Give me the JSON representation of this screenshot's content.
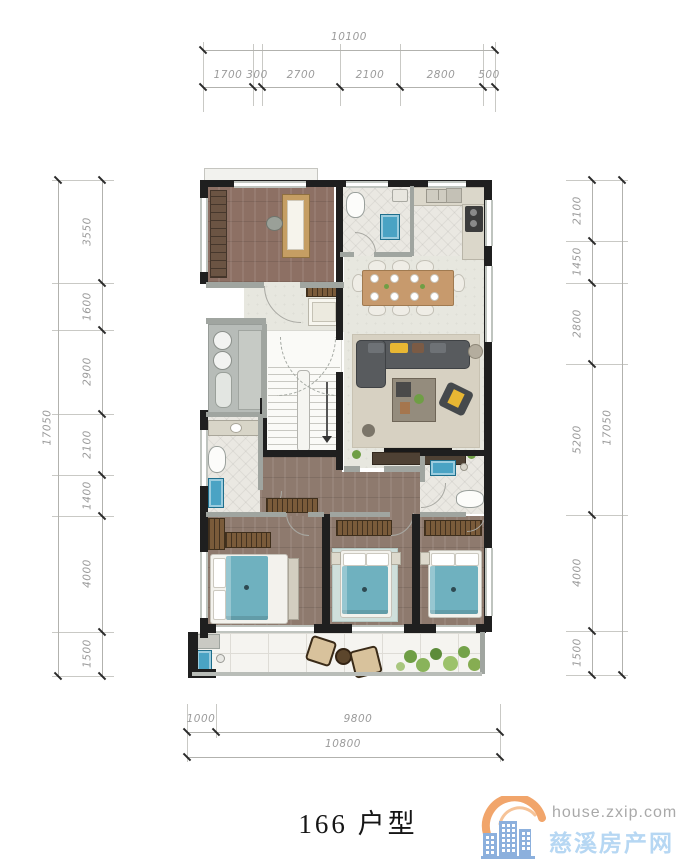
{
  "title": "166 户型",
  "dimensions": {
    "top": {
      "total": "10100",
      "segments": [
        "1700",
        "300",
        "2700",
        "2100",
        "2800",
        "500"
      ]
    },
    "left": {
      "total": "17050",
      "segments": [
        "3550",
        "1600",
        "2900",
        "2100",
        "1400",
        "4000",
        "1500"
      ]
    },
    "right": {
      "total": "17050",
      "segments": [
        "2100",
        "1450",
        "2800",
        "5200",
        "4000",
        "1500"
      ]
    },
    "bottom": {
      "total": "10800",
      "segments": [
        "1000",
        "9800"
      ]
    }
  },
  "watermark": {
    "domain": "house.zxip.com",
    "site_name": "慈溪房产网",
    "logo_icon": "buildings-arc-logo"
  },
  "colors": {
    "wall": "#1f1f1f",
    "wood_floor": "#8d7064",
    "tile_floor": "#eae8e2",
    "hall_floor": "#e7e7df",
    "bed_teal": "#6fb1bf",
    "fixture_teal": "#4aa3c4",
    "accent_yellow": "#e8b733",
    "wardrobe_brown": "#7a5b3a",
    "dim_text": "#9b9b9b",
    "logo_orange": "#f1a56b",
    "logo_blue": "#8cb0dd",
    "watermark_blue": "#b6d7f3",
    "watermark_gray": "#a9a9a9"
  }
}
